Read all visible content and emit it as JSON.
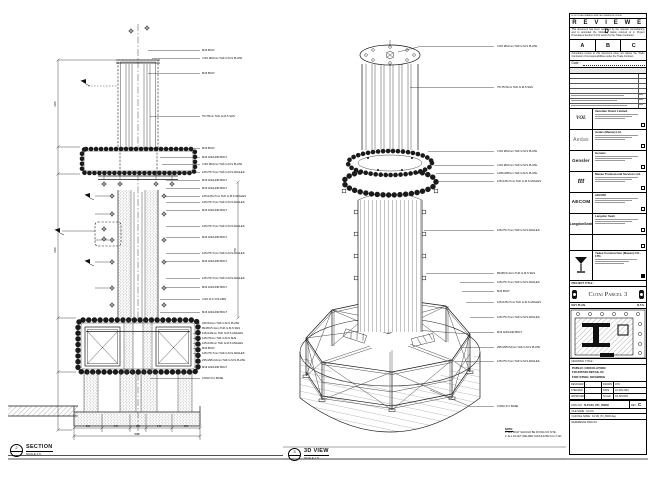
{
  "views": {
    "section": {
      "num": "2",
      "ref": "-",
      "title": "SECTION",
      "scale": "SCALE 1:5"
    },
    "iso": {
      "num": "3",
      "ref": "-",
      "title": "3D VIEW",
      "scale": "SCALE 1:5"
    }
  },
  "note": {
    "title": "NOTE:",
    "lines": [
      "1. ALL BOLT SHOULD BE FIXING ON SITE.",
      "2. ALL FILLET WELDED SHOULD BE 6mm THK."
    ]
  },
  "section_labels": [
    "M16 BOLT",
    "4 NO Ø10mm THK G.M.S PLATE",
    "M16 BOLT",
    "75×75mm THK G.M.S SHS",
    "M16 BOLT",
    "M16 ANCHOR BOLT",
    "4 NO Ø10mm THK G.M.S PLATE",
    "125×75×7mm THK G.M.S ANGLES",
    "M16 ANCHOR BOLT",
    "M16 ANCHOR BOLT",
    "125×125×7mm THK G.M.S ANGLES",
    "125×75×7mm THK G.M.S ANGLES",
    "M16 ANCHOR BOLT",
    "125×75×7mm THK G.M.S ANGLES",
    "M16 ANCHOR BOLT",
    "125×75×7mm THK G.M.S ANGLES",
    "M16 ANCHOR BOLT",
    "125×75×7mm THK G.M.S ANGLES",
    "M16 ANCHOR BOLT",
    "4 NO R.C COLUMN",
    "M16 ANCHOR BOLT",
    "340×10mm THK G.M.S PLATE",
    "89×89×5.4mm THK G.M.S SHS",
    "125×125mm THK G.M.S ANGLES",
    "125×75mm THK G.M.S SHS",
    "125×125mm THK G.M.S ANGLES",
    "M16 BOLT",
    "125×75×7mm THK G.M.S ANGLES",
    "295×295×10mm THK G.M.S PLATE",
    "M16 ANCHOR BOLT",
    "CONC R.C BASE"
  ],
  "iso_labels": [
    "4 NO Ø10mm THK G.M.S PLATE",
    "75×75×5mm THK G.M.S SHS",
    "4 NO Ø10mm THK G.M.S PLATE",
    "4 NO Ø10mm THK G.M.S PLATE",
    "L295×295mm THK G.M.S PLATE",
    "125×125×7mm THK G.M.S ANGLES",
    "125×75×7mm THK G.M.S ANGLES",
    "89×89×5.4mm THK G.M.S SHS",
    "125×75×7mm THK G.M.S ANGLES",
    "M16 BOLT",
    "125×125×7mm THK G.M.S ANGLES",
    "125×75×7mm THK G.M.S ANGLES",
    "M16 ANCHOR BOLT",
    "295×295×10mm THK G.M.S PLATE",
    "125×75×7mm THK G.M.S ANGLES",
    "CONC R.C BASE"
  ],
  "dims": {
    "bottom": [
      "600",
      "940",
      "600",
      "940",
      "600"
    ],
    "bottom_total": "3680",
    "left": [
      "1450",
      "2400"
    ],
    "right": "750"
  },
  "titleblock": {
    "disclaimer": "DO NOT SCALE DRAWING. VERIFY ALL DIMENSIONS ON SITE.",
    "reviewed": "R E V I E W E D",
    "review_para1": "This document has been reviewed by the relevant Consultant(s) and is accorded the following status referred to in Project Procedures Section 5.4 for action by the Trade Contractor.",
    "abc": [
      "A",
      "B",
      "C"
    ],
    "review_para2": "Consultant review of this document does not relieve the Trade Contractor of its responsibilities under the Trade Contract.",
    "date_label": "Date :",
    "consultants": [
      {
        "logo": "VOL",
        "name": "Venetian Orient Limited"
      },
      {
        "logo": "Aedas",
        "name": "Aedas (Macau) Ltd."
      },
      {
        "logo": "Gensler",
        "name": "Gensler"
      },
      {
        "logo": "ttt",
        "name": "Macau Professional Services Ltd."
      },
      {
        "logo": "AECOM",
        "name": "AECOM"
      },
      {
        "logo": "LangdonSeah",
        "name": "Langdon Seah"
      }
    ],
    "contractor": {
      "name": "Yadea Construction (Macau) CO., LTD."
    },
    "project_title_label": "PROJECT TITLE :",
    "project_title": "Cotai Parcel 3",
    "key_plan_label": "KEY PLAN",
    "key_plan_scale": "N.T.S.",
    "drawing_title_label": "DRAWING TITLE :",
    "drawing_title_lines": [
      "PUBLIC CIRCULATION",
      "FOUNTAIN DETAIL IN",
      "FOR STEEL DRAWING"
    ],
    "fields": {
      "designed_label": "DESIGNED",
      "designed": "-",
      "drawn_label": "DRAWN",
      "drawn": "LHO",
      "checked_label": "CHECKED",
      "checked": "-",
      "date_label": "DATE",
      "date": "04 JAN 2010",
      "approved_label": "APPROVED",
      "approved": "-",
      "scale_label": "SCALE",
      "scale": "AS SHOWN",
      "dwg_label": "DWG NO :",
      "dwg_no": "S-FUN_PC_B009",
      "rev_label": "REV :",
      "rev": "C",
      "file_label": "FILE NAME :",
      "file": "S-FUN",
      "cad_label": "CAD FILE NAME :",
      "cad": "S-FUN_PC_B009.dwg",
      "ref_label": "REFERENCE DWG NO :"
    }
  }
}
